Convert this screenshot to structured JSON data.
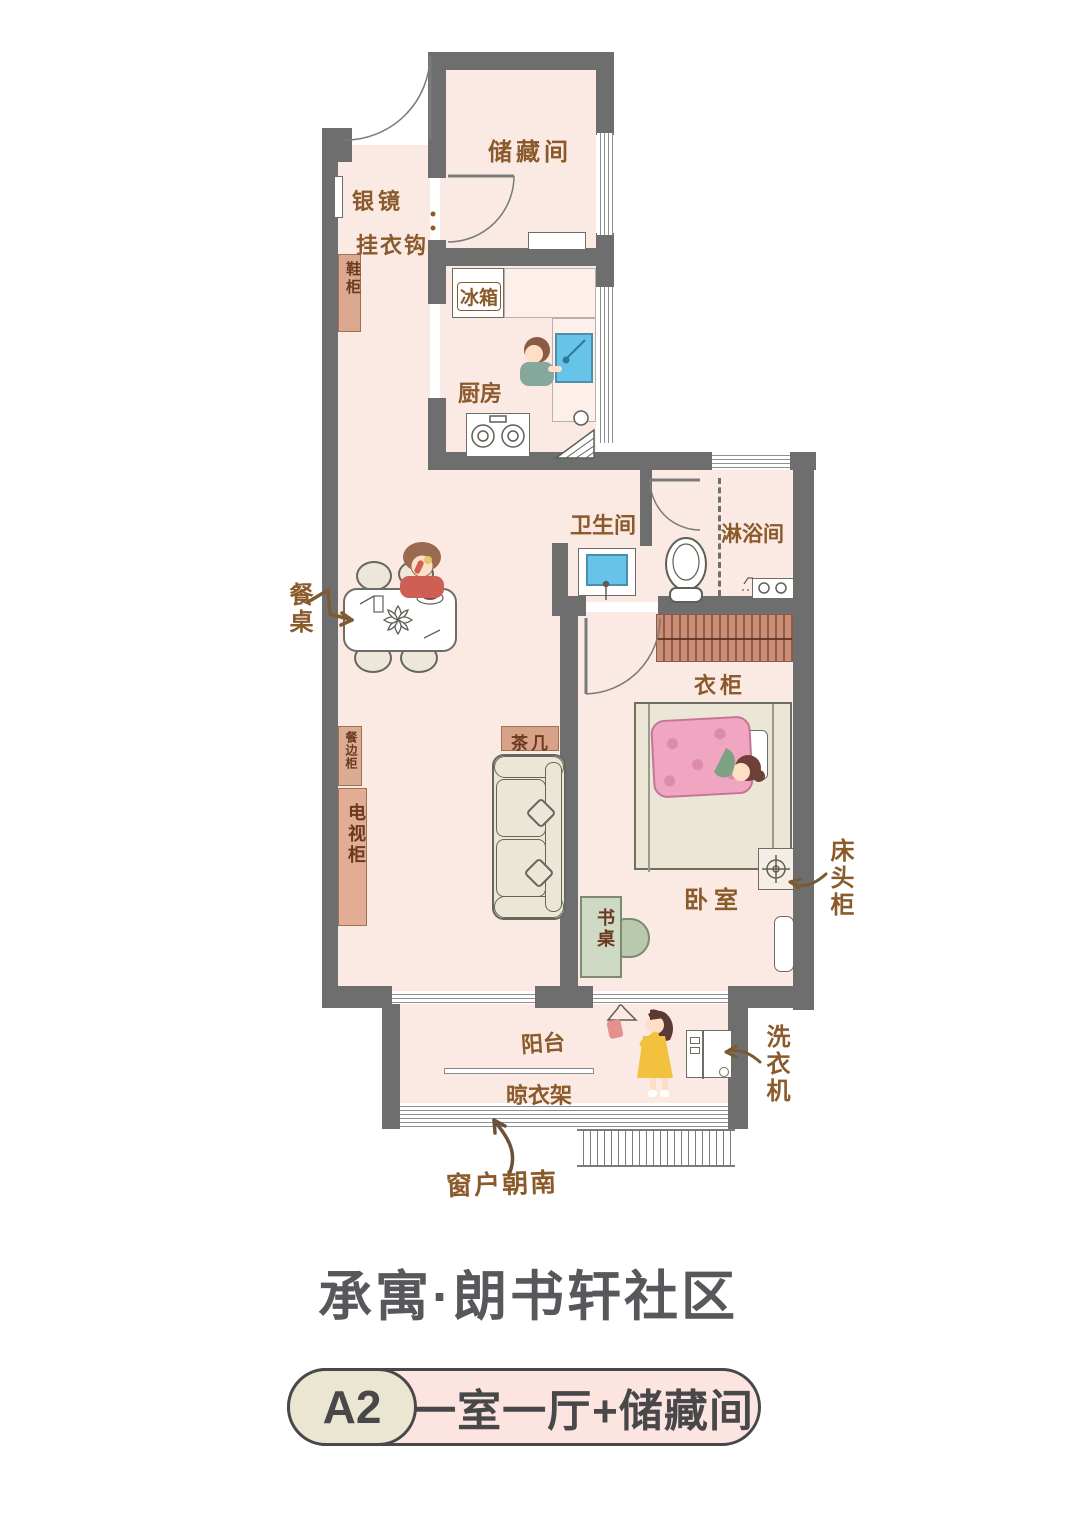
{
  "plan": {
    "labels": {
      "storage": "储藏间",
      "mirror": "银镜",
      "coat_hooks": "挂衣钩",
      "shoe_cabinet": "鞋柜",
      "fridge": "冰箱",
      "kitchen": "厨房",
      "bathroom": "卫生间",
      "shower": "淋浴间",
      "dining_table": "餐桌",
      "wardrobe": "衣柜",
      "tea_table": "茶几",
      "sideboard": "餐边柜",
      "tv_cabinet": "电视柜",
      "bedroom": "卧室",
      "bedside_table": "床头柜",
      "desk": "书桌",
      "balcony": "阳台",
      "drying_rack": "晾衣架",
      "washing_machine": "洗衣机",
      "south_window": "窗户朝南"
    }
  },
  "footer": {
    "community_name": "承寓·朗书轩社区",
    "unit_code": "A2",
    "unit_type": "一室一厅+储藏间"
  },
  "colors": {
    "wall": "#6f6e6e",
    "floor": "#fbe9e3",
    "label_text": "#8a5a2b",
    "furniture_brown": "#d9a88e",
    "wardrobe_brown": "#c98e78",
    "sink_blue": "#67c3e8",
    "bed_cream": "#ebe6d6",
    "desk_green": "#cedac3",
    "blanket_pink": "#f0a5c0",
    "title_gray": "#58575b",
    "badge_cream": "#eae6d1",
    "badge_pink": "#fce5e1",
    "outline_dark": "#48484a"
  }
}
